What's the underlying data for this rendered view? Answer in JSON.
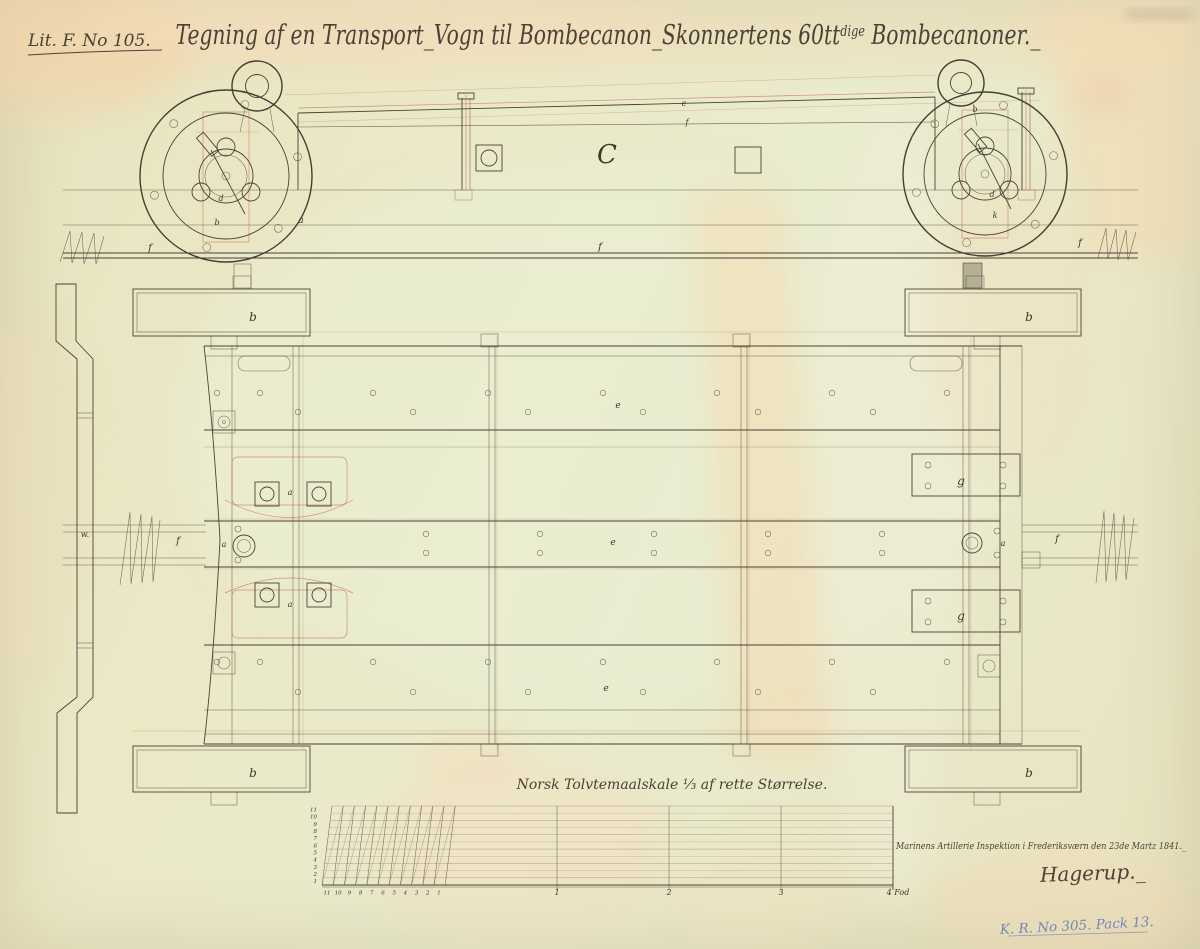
{
  "palette": {
    "paper": "#e9e6c2",
    "ink": "#4a4238",
    "red_ink": "#c4705a",
    "blue_note": "#7289b8",
    "stain": "#f6d8ae",
    "gray_block": "#b5af93"
  },
  "header": {
    "archive_ref": "Lit. F. No 105.",
    "title_part1": "Tegning af en Transport_Vogn til Bombecanon_Skonnertens 60tt",
    "title_sup": "dige",
    "title_part2": " Bombecanoner._"
  },
  "drawing": {
    "view_label": "C",
    "part_labels": [
      {
        "t": "f",
        "x": 150,
        "y": 251,
        "s": 10
      },
      {
        "t": "f",
        "x": 600,
        "y": 250,
        "s": 10
      },
      {
        "t": "f",
        "x": 1080,
        "y": 246,
        "s": 10
      },
      {
        "t": "C",
        "x": 607,
        "y": 163,
        "s": 26
      },
      {
        "t": "e",
        "x": 684,
        "y": 106,
        "s": 8
      },
      {
        "t": "f",
        "x": 687,
        "y": 125,
        "s": 8
      },
      {
        "t": "d",
        "x": 221,
        "y": 201,
        "s": 8
      },
      {
        "t": "b",
        "x": 217,
        "y": 225,
        "s": 8
      },
      {
        "t": "a",
        "x": 301,
        "y": 223,
        "s": 9
      },
      {
        "t": "b",
        "x": 975,
        "y": 112,
        "s": 8
      },
      {
        "t": "d",
        "x": 992,
        "y": 197,
        "s": 8
      },
      {
        "t": "k",
        "x": 995,
        "y": 218,
        "s": 8
      },
      {
        "t": "b",
        "x": 253,
        "y": 321,
        "s": 12
      },
      {
        "t": "b",
        "x": 1029,
        "y": 321,
        "s": 12
      },
      {
        "t": "b",
        "x": 253,
        "y": 777,
        "s": 12
      },
      {
        "t": "b",
        "x": 1029,
        "y": 777,
        "s": 12
      },
      {
        "t": "e",
        "x": 618,
        "y": 408,
        "s": 9
      },
      {
        "t": "e",
        "x": 613,
        "y": 545,
        "s": 9
      },
      {
        "t": "e",
        "x": 606,
        "y": 691,
        "s": 9
      },
      {
        "t": "a",
        "x": 290,
        "y": 495,
        "s": 8
      },
      {
        "t": "a",
        "x": 290,
        "y": 607,
        "s": 8
      },
      {
        "t": "a",
        "x": 224,
        "y": 547,
        "s": 8
      },
      {
        "t": "a",
        "x": 1003,
        "y": 546,
        "s": 8
      },
      {
        "t": "f",
        "x": 178,
        "y": 544,
        "s": 10
      },
      {
        "t": "f",
        "x": 1057,
        "y": 542,
        "s": 10
      },
      {
        "t": "g",
        "x": 961,
        "y": 485,
        "s": 12
      },
      {
        "t": "g",
        "x": 961,
        "y": 620,
        "s": 12
      },
      {
        "t": "w.",
        "x": 85,
        "y": 537,
        "s": 8
      }
    ]
  },
  "scale": {
    "caption": "Norsk Tolvtemaalskale ⅓ af rette Størrelse.",
    "inch_left": [
      "11",
      "10",
      "9",
      "8",
      "7",
      "6",
      "5",
      "4",
      "3",
      "2",
      "1"
    ],
    "inch_bottom": [
      "11",
      "10",
      "9",
      "8",
      "7",
      "6",
      "5",
      "4",
      "3",
      "2",
      "1"
    ],
    "foot_marks": [
      {
        "label": "1",
        "x": 557
      },
      {
        "label": "2",
        "x": 669
      },
      {
        "label": "3",
        "x": 781
      },
      {
        "label": "4 Fod",
        "x": 898
      }
    ]
  },
  "inscription": {
    "line1": "Marinens Artillerie Inspektion i Frederiksværn den 23de Martz 1841._",
    "signature": "Hagerup._"
  },
  "annotations": {
    "blue_note": "K. R. No 305. Pack 13."
  }
}
